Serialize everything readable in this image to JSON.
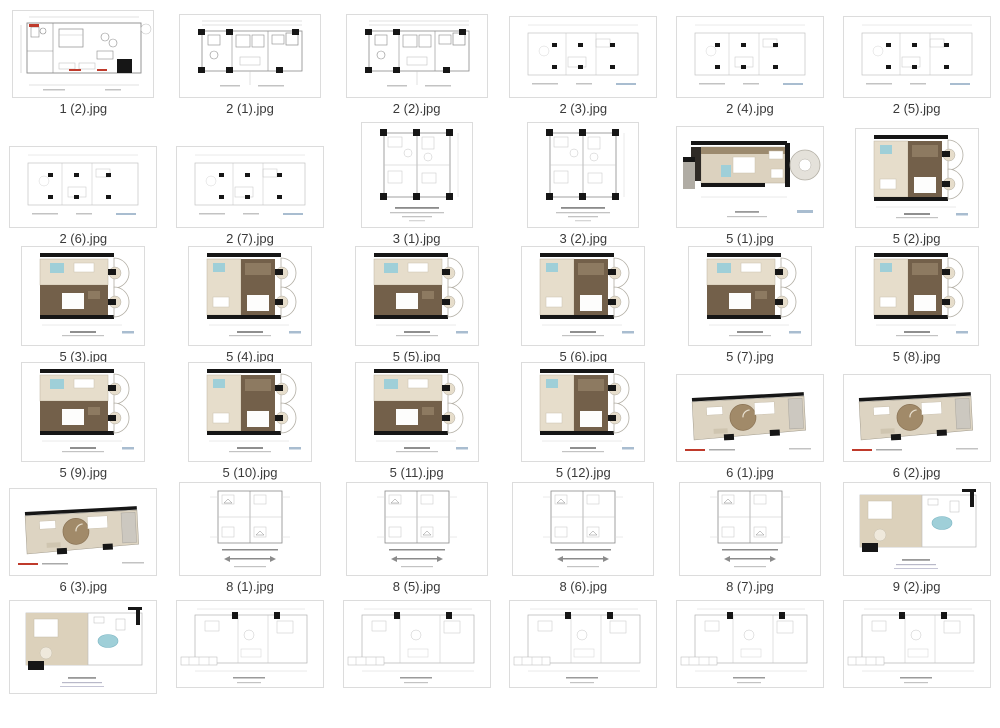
{
  "gallery": {
    "items": [
      {
        "label": "1 (2).jpg",
        "type": "cad-red-h"
      },
      {
        "label": "2 (1).jpg",
        "type": "cad-dense-h"
      },
      {
        "label": "2 (2).jpg",
        "type": "cad-dense-h"
      },
      {
        "label": "2 (3).jpg",
        "type": "cad-faint-h"
      },
      {
        "label": "2 (4).jpg",
        "type": "cad-faint-h"
      },
      {
        "label": "2 (5).jpg",
        "type": "cad-faint-h"
      },
      {
        "label": "2 (6).jpg",
        "type": "cad-faint-h"
      },
      {
        "label": "2 (7).jpg",
        "type": "cad-faint-h"
      },
      {
        "label": "3 (1).jpg",
        "type": "cad-square"
      },
      {
        "label": "3 (2).jpg",
        "type": "cad-square"
      },
      {
        "label": "5 (1).jpg",
        "type": "color-h"
      },
      {
        "label": "5 (2).jpg",
        "type": "color-sq"
      },
      {
        "label": "5 (3).jpg",
        "type": "color-sq"
      },
      {
        "label": "5 (4).jpg",
        "type": "color-sq"
      },
      {
        "label": "5 (5).jpg",
        "type": "color-sq"
      },
      {
        "label": "5 (6).jpg",
        "type": "color-sq"
      },
      {
        "label": "5 (7).jpg",
        "type": "color-sq"
      },
      {
        "label": "5 (8).jpg",
        "type": "color-sq"
      },
      {
        "label": "5 (9).jpg",
        "type": "color-sq"
      },
      {
        "label": "5 (10).jpg",
        "type": "color-sq"
      },
      {
        "label": "5 (11).jpg",
        "type": "color-sq"
      },
      {
        "label": "5 (12).jpg",
        "type": "color-sq"
      },
      {
        "label": "6 (1).jpg",
        "type": "color-angled"
      },
      {
        "label": "6 (2).jpg",
        "type": "color-angled"
      },
      {
        "label": "6 (3).jpg",
        "type": "color-angled"
      },
      {
        "label": "8 (1).jpg",
        "type": "cad-stamp-sq"
      },
      {
        "label": "8 (5).jpg",
        "type": "cad-stamp-sq"
      },
      {
        "label": "8 (6).jpg",
        "type": "cad-stamp-sq"
      },
      {
        "label": "8 (7).jpg",
        "type": "cad-stamp-sq"
      },
      {
        "label": "9 (2).jpg",
        "type": "color-h2"
      },
      {
        "label": "",
        "type": "color-h2"
      },
      {
        "label": "",
        "type": "cad-wide"
      },
      {
        "label": "",
        "type": "cad-wide"
      },
      {
        "label": "",
        "type": "cad-wide"
      },
      {
        "label": "",
        "type": "cad-wide"
      },
      {
        "label": "",
        "type": "cad-wide"
      }
    ]
  },
  "palette": {
    "card_border": "#dcdcdc",
    "label_text": "#3a3a3a",
    "line_dark": "#8b8b8b",
    "line_light": "#c3c3c3",
    "line_faint": "#d6d6d6",
    "black": "#161616",
    "red": "#bf3a2b",
    "tan": "#dcd2bf",
    "tan_light": "#e6ddcb",
    "brown": "#73604a",
    "brown_mid": "#9c8a6e",
    "blue": "#9fcfd8",
    "gray_balcony": "#b2aea4",
    "gray_fill": "#e4e1da",
    "scale_blue": "#a9bdd0"
  }
}
